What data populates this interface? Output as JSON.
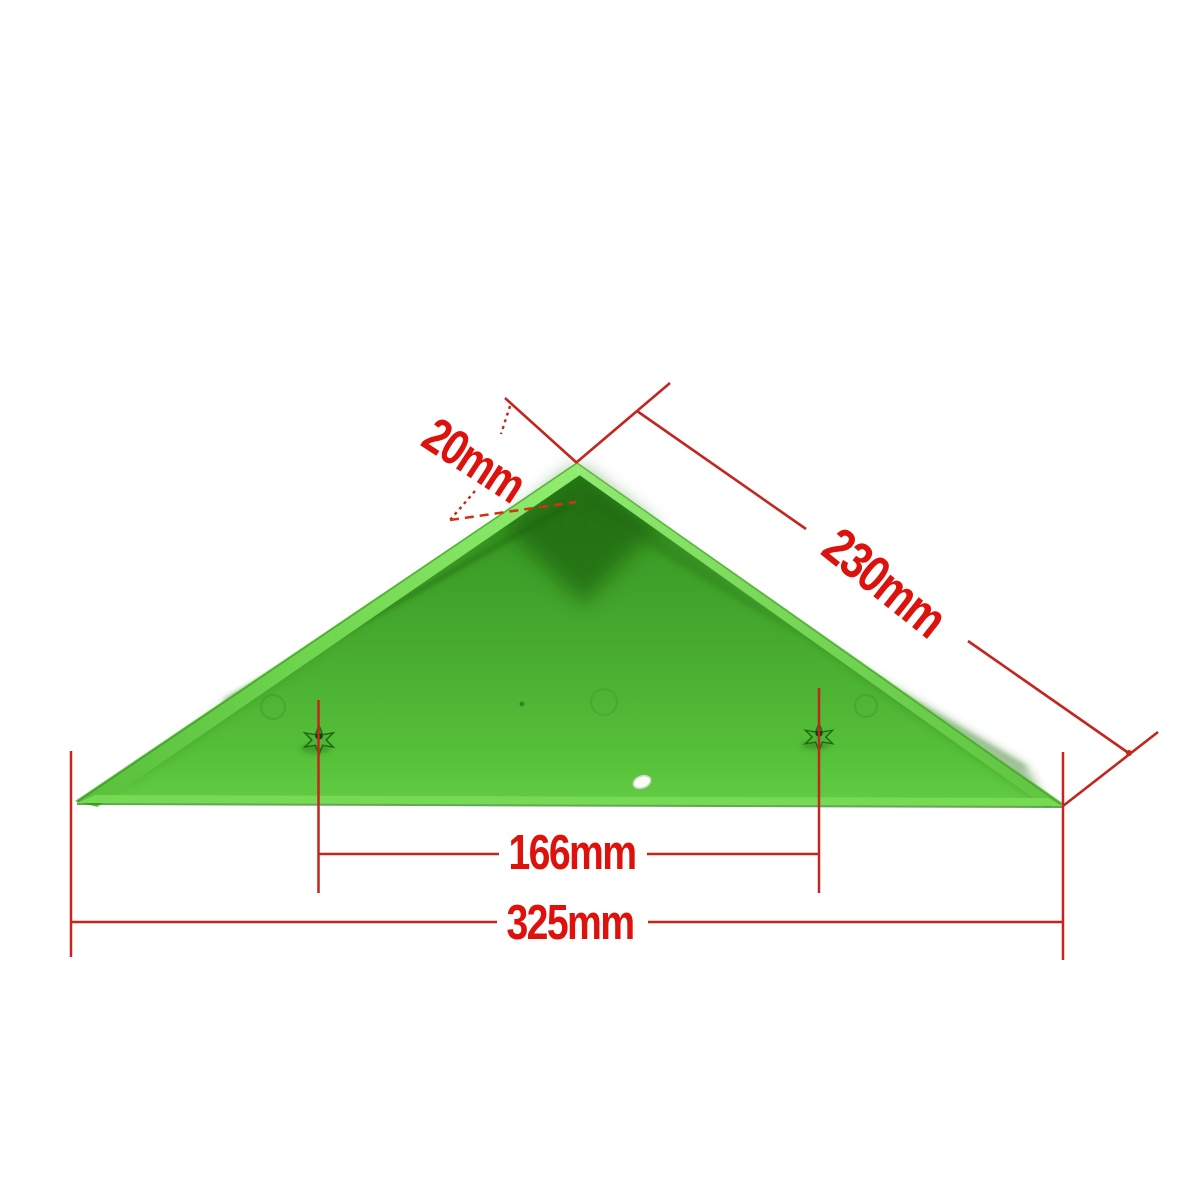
{
  "colors": {
    "background": "#ffffff",
    "annotation_red": "#dd120c",
    "dimension_line_red": "#c3261f",
    "shelf_green": "#46aa2e",
    "shelf_green_light": "#82e260",
    "shelf_green_dark": "#1e6c10"
  },
  "dimensions": {
    "lip_depth": "20mm",
    "edge_length": "230mm",
    "screw_spacing": "166mm",
    "base_width": "325mm"
  }
}
